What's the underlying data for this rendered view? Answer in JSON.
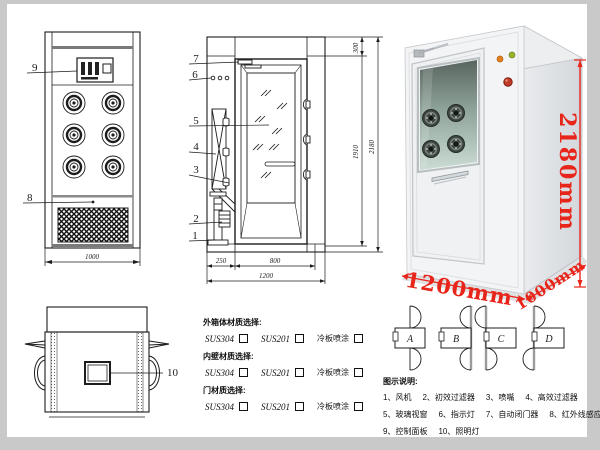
{
  "front_view": {
    "label_9": "9",
    "label_8": "8",
    "dim_width": "1000"
  },
  "side_view": {
    "part_labels": [
      "1",
      "2",
      "3",
      "4",
      "5",
      "6",
      "7"
    ],
    "dims": {
      "top_offset": "300",
      "door_height": "1910",
      "total_height": "2180",
      "left_depth": "250",
      "door_width": "800",
      "total_width": "1200"
    }
  },
  "photo": {
    "dims": {
      "height": "2180mm",
      "width": "1200mm",
      "depth": "1000mm"
    }
  },
  "top_view": {
    "part_label": "10"
  },
  "materials": {
    "groups": [
      {
        "title": "外箱体材质选择:",
        "options": [
          "SUS304",
          "SUS201",
          "冷板喷涂"
        ]
      },
      {
        "title": "内壁材质选择:",
        "options": [
          "SUS304",
          "SUS201",
          "冷板喷涂"
        ]
      },
      {
        "title": "门材质选择:",
        "options": [
          "SUS304",
          "SUS201",
          "冷板喷涂"
        ]
      }
    ]
  },
  "door_configs": {
    "labels": [
      "A",
      "B",
      "C",
      "D"
    ]
  },
  "legend": {
    "title": "图示说明:",
    "items": [
      "1、风机",
      "2、初效过滤器",
      "3、喷嘴",
      "4、高效过滤器",
      "5、玻璃视窗",
      "6、指示灯",
      "7、自动闭门器",
      "8、红外线感应器",
      "9、控制面板",
      "10、照明灯"
    ]
  },
  "colors": {
    "dimension_red": "#e8251a",
    "line_black": "#1c1c1c",
    "frame_gray": "#c9c9c9",
    "indicator_orange": "#e2801d",
    "indicator_green": "#96b32e",
    "button_red": "#c13a28"
  }
}
